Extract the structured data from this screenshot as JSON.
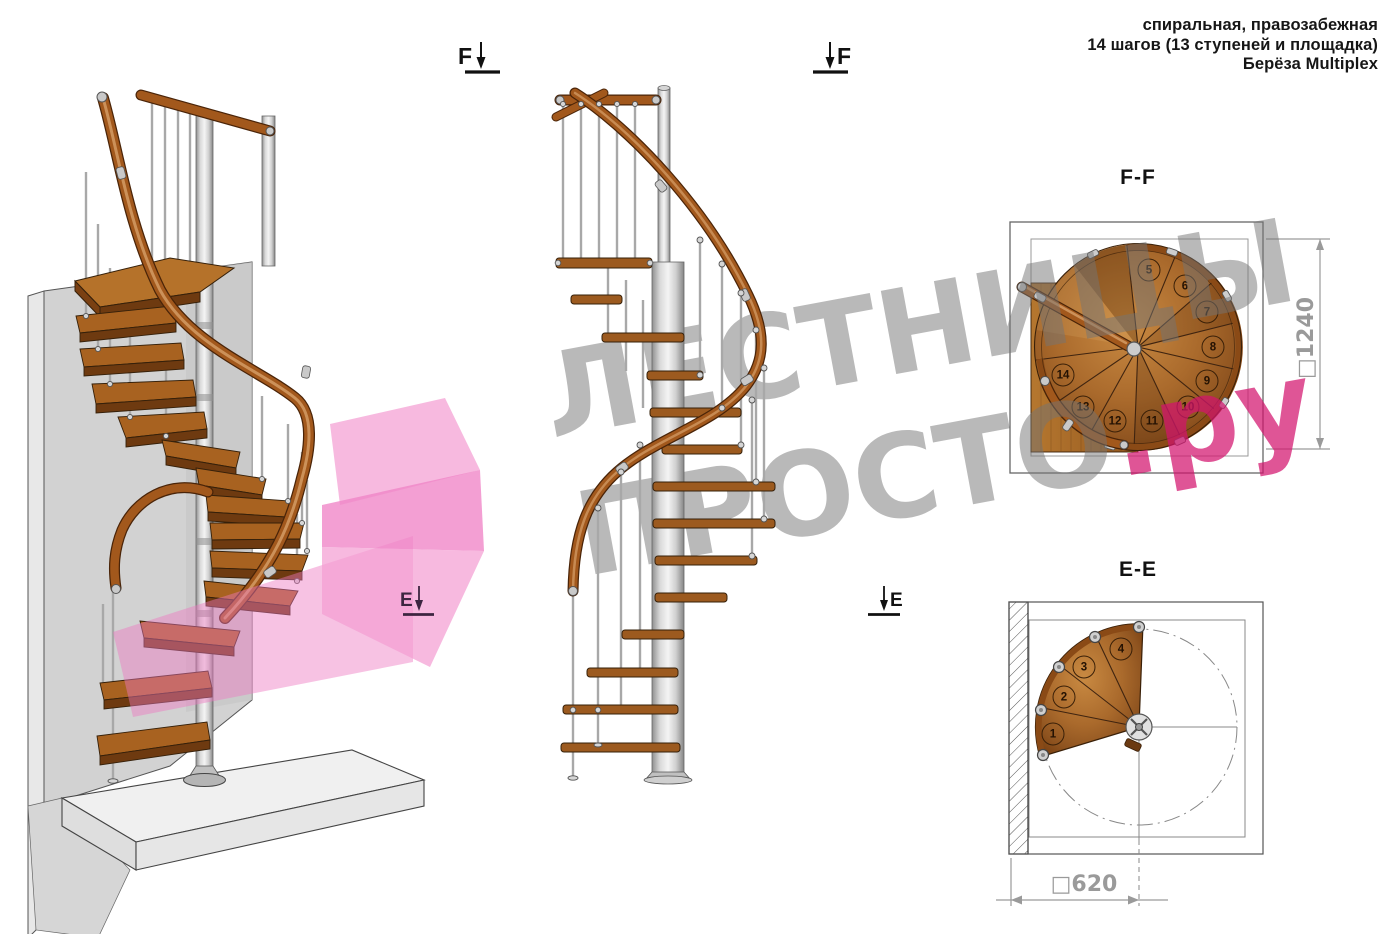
{
  "header": {
    "line1": "спиральная, правозабежная",
    "line2": "14 шагов (13 ступеней и площадка)",
    "line3": "Берёза Multiplex"
  },
  "watermark": {
    "line1": "ЛЕСТНИЦЫ",
    "line2_gray": "ПРОСТО",
    "line2_pink": ".ру"
  },
  "section_markers": {
    "f_left": "F",
    "f_right": "F",
    "e_left": "E",
    "e_right": "E"
  },
  "plan_ff": {
    "title": "F-F",
    "dim_label": "□1240",
    "steps": [
      {
        "label": "5",
        "x": 1149,
        "y": 270
      },
      {
        "label": "6",
        "x": 1185,
        "y": 286
      },
      {
        "label": "7",
        "x": 1207,
        "y": 312
      },
      {
        "label": "8",
        "x": 1213,
        "y": 347
      },
      {
        "label": "9",
        "x": 1207,
        "y": 381
      },
      {
        "label": "10",
        "x": 1188,
        "y": 407
      },
      {
        "label": "11",
        "x": 1152,
        "y": 421
      },
      {
        "label": "12",
        "x": 1115,
        "y": 421
      },
      {
        "label": "13",
        "x": 1083,
        "y": 407
      },
      {
        "label": "14",
        "x": 1063,
        "y": 375
      }
    ]
  },
  "plan_ee": {
    "title": "E-E",
    "dim_label": "□620",
    "steps": [
      {
        "label": "1",
        "x": 1053,
        "y": 734
      },
      {
        "label": "2",
        "x": 1064,
        "y": 697
      },
      {
        "label": "3",
        "x": 1084,
        "y": 667
      },
      {
        "label": "4",
        "x": 1121,
        "y": 649
      }
    ]
  },
  "colors": {
    "wood": "#a86220",
    "wood_dark": "#6e3a10",
    "rail": "#a2581c",
    "metal": "#c8c8c8",
    "pink_accent": "#de5696",
    "dim_gray": "#9a9a9a",
    "watermark_gray": "#b3b3b3"
  }
}
